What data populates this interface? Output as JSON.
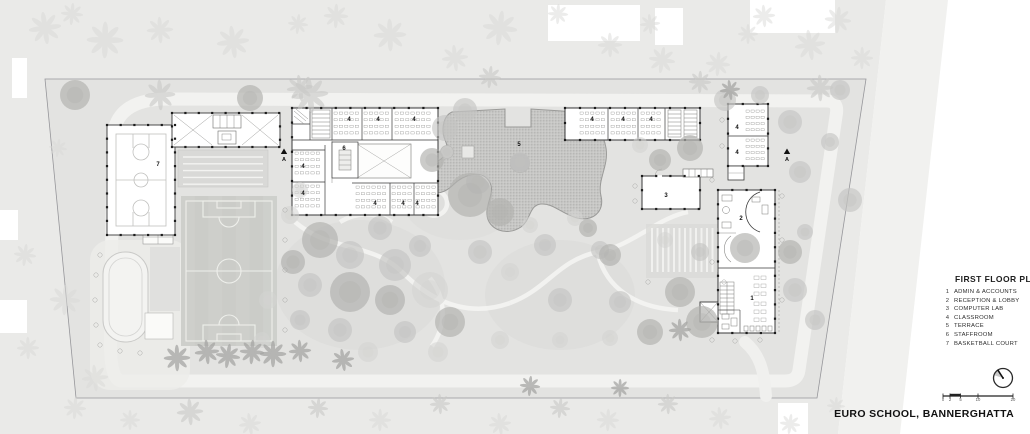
{
  "page": {
    "project_title": "EURO SCHOOL, BANNERGHATTA"
  },
  "legend": {
    "title": "FIRST FLOOR PLAN",
    "items": [
      {
        "num": "1",
        "label": "ADMIN & ACCOUNTS"
      },
      {
        "num": "2",
        "label": "RECEPTION & LOBBY"
      },
      {
        "num": "3",
        "label": "COMPUTER LAB"
      },
      {
        "num": "4",
        "label": "CLASSROOM"
      },
      {
        "num": "5",
        "label": "TERRACE"
      },
      {
        "num": "6",
        "label": "STAFFROOM"
      },
      {
        "num": "7",
        "label": "BASKETBALL COURT"
      }
    ]
  },
  "scale_bar": {
    "ticks": [
      "0",
      "2",
      "5",
      "10",
      "20"
    ]
  },
  "compass": {
    "icon": "north-arrow"
  },
  "colors": {
    "ink": "#3a3a3a",
    "ground": "#e4e4e2",
    "outside": "#eaeae8",
    "road": "#f2f2f0",
    "field": "#cbccc8",
    "terrace": "#c6c6c4"
  },
  "plan": {
    "room_labels": [
      {
        "t": "7",
        "x": 158,
        "y": 166
      },
      {
        "t": "6",
        "x": 344,
        "y": 150
      },
      {
        "t": "5",
        "x": 519,
        "y": 146
      },
      {
        "t": "3",
        "x": 666,
        "y": 197
      },
      {
        "t": "2",
        "x": 741,
        "y": 220
      },
      {
        "t": "1",
        "x": 752,
        "y": 300
      },
      {
        "t": "4",
        "x": 349,
        "y": 121
      },
      {
        "t": "4",
        "x": 378,
        "y": 121
      },
      {
        "t": "4",
        "x": 414,
        "y": 121
      },
      {
        "t": "4",
        "x": 303,
        "y": 168
      },
      {
        "t": "4",
        "x": 303,
        "y": 195
      },
      {
        "t": "4",
        "x": 375,
        "y": 205
      },
      {
        "t": "4",
        "x": 403,
        "y": 205
      },
      {
        "t": "4",
        "x": 417,
        "y": 205
      },
      {
        "t": "4",
        "x": 592,
        "y": 121
      },
      {
        "t": "4",
        "x": 623,
        "y": 121
      },
      {
        "t": "4",
        "x": 651,
        "y": 121
      },
      {
        "t": "4",
        "x": 737,
        "y": 129
      },
      {
        "t": "4",
        "x": 737,
        "y": 154
      }
    ],
    "section_markers": [
      {
        "label": "A",
        "x": 284,
        "y": 152
      },
      {
        "label": "A",
        "x": 787,
        "y": 152
      }
    ],
    "trees": [
      [
        75,
        95,
        15,
        2
      ],
      [
        250,
        98,
        13,
        2
      ],
      [
        432,
        160,
        12,
        2
      ],
      [
        445,
        128,
        13,
        1
      ],
      [
        465,
        110,
        12,
        1
      ],
      [
        478,
        182,
        12,
        1
      ],
      [
        470,
        195,
        22,
        2
      ],
      [
        500,
        212,
        14,
        2
      ],
      [
        520,
        162,
        10,
        1
      ],
      [
        447,
        152,
        7,
        1
      ],
      [
        290,
        215,
        9,
        0
      ],
      [
        300,
        190,
        8,
        0
      ],
      [
        320,
        240,
        18,
        2
      ],
      [
        350,
        255,
        14,
        1
      ],
      [
        380,
        228,
        12,
        1
      ],
      [
        395,
        265,
        16,
        1
      ],
      [
        420,
        246,
        11,
        1
      ],
      [
        293,
        262,
        12,
        2
      ],
      [
        310,
        285,
        12,
        1
      ],
      [
        350,
        292,
        20,
        2
      ],
      [
        390,
        300,
        15,
        2
      ],
      [
        430,
        290,
        18,
        0
      ],
      [
        300,
        320,
        10,
        1
      ],
      [
        340,
        330,
        12,
        1
      ],
      [
        405,
        332,
        11,
        1
      ],
      [
        450,
        322,
        15,
        2
      ],
      [
        368,
        352,
        10,
        0
      ],
      [
        438,
        352,
        10,
        0
      ],
      [
        480,
        252,
        12,
        1
      ],
      [
        510,
        272,
        9,
        0
      ],
      [
        530,
        225,
        8,
        0
      ],
      [
        545,
        245,
        11,
        1
      ],
      [
        560,
        300,
        12,
        1
      ],
      [
        575,
        218,
        8,
        0
      ],
      [
        588,
        228,
        9,
        2
      ],
      [
        600,
        250,
        9,
        1
      ],
      [
        610,
        255,
        11,
        2
      ],
      [
        620,
        302,
        11,
        1
      ],
      [
        650,
        332,
        13,
        2
      ],
      [
        610,
        338,
        8,
        0
      ],
      [
        500,
        340,
        9,
        0
      ],
      [
        560,
        340,
        8,
        0
      ],
      [
        640,
        145,
        8,
        0
      ],
      [
        660,
        160,
        11,
        2
      ],
      [
        690,
        148,
        13,
        2
      ],
      [
        665,
        240,
        8,
        0
      ],
      [
        700,
        252,
        9,
        1
      ],
      [
        680,
        292,
        15,
        2
      ],
      [
        702,
        322,
        16,
        2
      ],
      [
        745,
        248,
        15,
        2
      ],
      [
        725,
        100,
        11,
        1
      ],
      [
        760,
        95,
        9,
        1
      ],
      [
        790,
        122,
        12,
        1
      ],
      [
        800,
        172,
        11,
        1
      ],
      [
        805,
        232,
        8,
        1
      ],
      [
        790,
        252,
        12,
        2
      ],
      [
        830,
        142,
        9,
        1
      ],
      [
        795,
        290,
        12,
        1
      ],
      [
        815,
        320,
        10,
        1
      ],
      [
        850,
        200,
        12,
        1
      ],
      [
        840,
        90,
        10,
        1
      ],
      [
        262,
        340,
        8,
        0
      ],
      [
        268,
        300,
        9,
        0
      ]
    ],
    "palms": [
      [
        45,
        28,
        16,
        0
      ],
      [
        72,
        14,
        11,
        0
      ],
      [
        105,
        40,
        18,
        0
      ],
      [
        160,
        30,
        13,
        0
      ],
      [
        233,
        42,
        16,
        0
      ],
      [
        298,
        24,
        10,
        0
      ],
      [
        336,
        16,
        12,
        0
      ],
      [
        390,
        35,
        16,
        0
      ],
      [
        455,
        58,
        13,
        0
      ],
      [
        500,
        28,
        17,
        0
      ],
      [
        558,
        14,
        10,
        0
      ],
      [
        610,
        45,
        12,
        0
      ],
      [
        650,
        24,
        10,
        0
      ],
      [
        662,
        60,
        13,
        0
      ],
      [
        718,
        64,
        12,
        0
      ],
      [
        748,
        34,
        10,
        0
      ],
      [
        764,
        16,
        11,
        0
      ],
      [
        810,
        45,
        15,
        0
      ],
      [
        838,
        20,
        13,
        0
      ],
      [
        862,
        58,
        11,
        0
      ],
      [
        160,
        95,
        15,
        1
      ],
      [
        300,
        88,
        13,
        1
      ],
      [
        490,
        77,
        11,
        1
      ],
      [
        700,
        82,
        11,
        1
      ],
      [
        820,
        88,
        13,
        1
      ],
      [
        310,
        95,
        18,
        1
      ],
      [
        25,
        255,
        11,
        0
      ],
      [
        65,
        300,
        15,
        0
      ],
      [
        28,
        348,
        11,
        0
      ],
      [
        95,
        378,
        13,
        0
      ],
      [
        58,
        148,
        9,
        0
      ],
      [
        75,
        408,
        11,
        0
      ],
      [
        130,
        420,
        10,
        0
      ],
      [
        190,
        412,
        13,
        1
      ],
      [
        250,
        424,
        11,
        0
      ],
      [
        318,
        408,
        10,
        1
      ],
      [
        380,
        420,
        11,
        0
      ],
      [
        440,
        404,
        10,
        1
      ],
      [
        500,
        424,
        11,
        0
      ],
      [
        560,
        408,
        10,
        1
      ],
      [
        608,
        420,
        11,
        0
      ],
      [
        668,
        404,
        10,
        1
      ],
      [
        720,
        418,
        11,
        0
      ],
      [
        790,
        424,
        10,
        0
      ],
      [
        836,
        406,
        9,
        0
      ],
      [
        177,
        358,
        13,
        2
      ],
      [
        207,
        352,
        12,
        2
      ],
      [
        228,
        356,
        12,
        2
      ],
      [
        252,
        352,
        12,
        2
      ],
      [
        273,
        354,
        13,
        2
      ],
      [
        300,
        351,
        11,
        2
      ],
      [
        343,
        360,
        11,
        2
      ],
      [
        530,
        386,
        10,
        2
      ],
      [
        620,
        388,
        9,
        2
      ],
      [
        680,
        330,
        11,
        2
      ],
      [
        730,
        90,
        10,
        2
      ]
    ],
    "shrubs": [
      [
        100,
        255
      ],
      [
        96,
        275
      ],
      [
        95,
        300
      ],
      [
        96,
        325
      ],
      [
        100,
        345
      ],
      [
        120,
        351
      ],
      [
        140,
        353
      ],
      [
        285,
        210
      ],
      [
        285,
        240
      ],
      [
        285,
        270
      ],
      [
        285,
        300
      ],
      [
        285,
        330
      ],
      [
        712,
        180
      ],
      [
        782,
        196
      ],
      [
        782,
        240
      ],
      [
        712,
        262
      ],
      [
        782,
        300
      ],
      [
        712,
        340
      ],
      [
        760,
        340
      ],
      [
        735,
        341
      ],
      [
        722,
        120
      ],
      [
        722,
        146
      ],
      [
        635,
        186
      ],
      [
        635,
        201
      ],
      [
        648,
        282
      ],
      [
        724,
        282
      ]
    ]
  }
}
